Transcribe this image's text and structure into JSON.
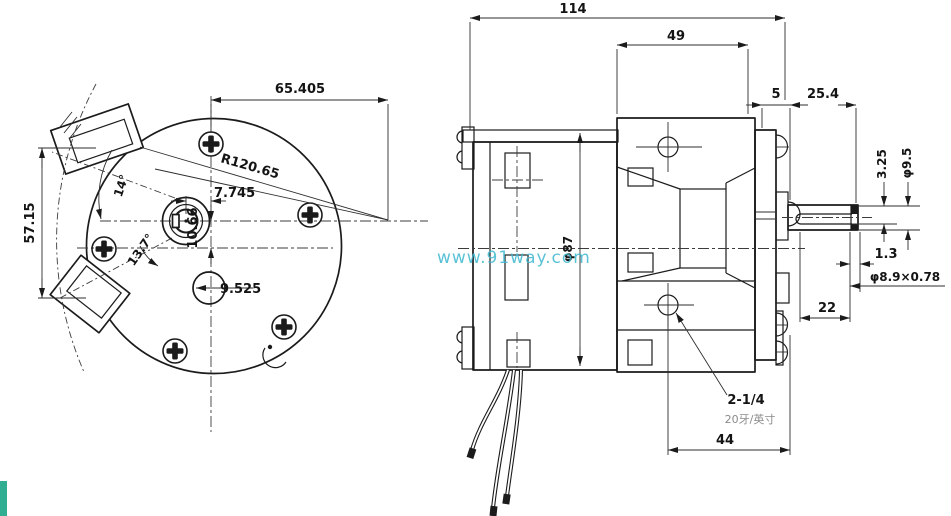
{
  "watermark": {
    "text": "www.91way.com",
    "color": "#3eb8cf"
  },
  "colors": {
    "line": "#1b1b1b",
    "background": "#ffffff",
    "corner_artifact": "#2fae92",
    "secondary_note": "#8a8a8a"
  },
  "front_view": {
    "labels": {
      "width": "65.405",
      "height": "57.15",
      "radius": "R120.65",
      "hub_offset_x": "7.745",
      "hub_offset_y": "10.66",
      "angle_upper": "14°",
      "angle_lower": "13.7°",
      "hole": "9.525"
    }
  },
  "side_view": {
    "labels": {
      "overall_length": "114",
      "gearbox_length": "49",
      "boss_length": "5",
      "shaft_length": "25.4",
      "shaft_flat_height": "3.25",
      "shaft_diameter": "φ9.5",
      "groove_width": "1.3",
      "groove_diameter": "φ8.9×0.78",
      "flat_length": "22",
      "body_diameter": "φ87",
      "hole_spacing": "44",
      "thread_size": "2-1/4",
      "thread_pitch": "20牙/英寸"
    }
  }
}
